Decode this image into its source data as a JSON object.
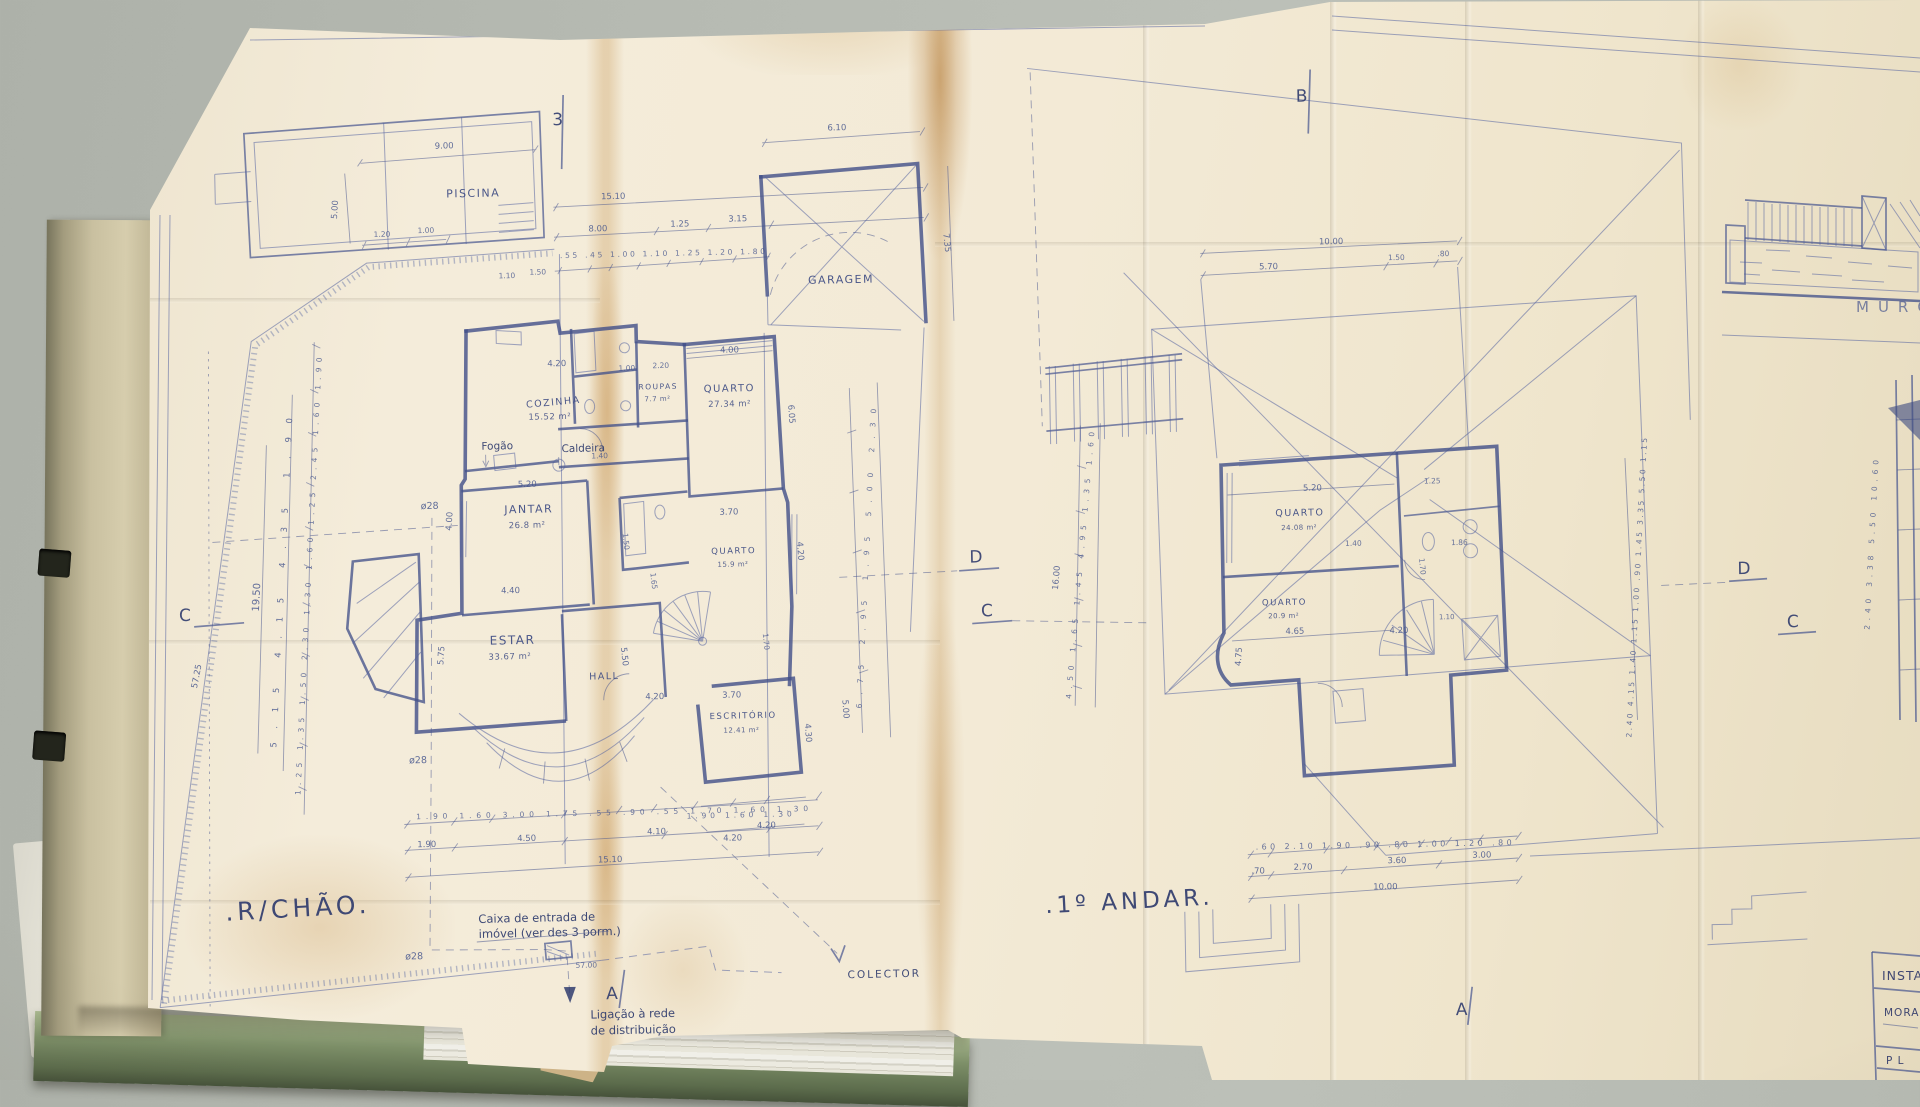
{
  "colors": {
    "desk": "#b7bbb3",
    "paper": "#f3ead6",
    "ink": "#44528b",
    "stain": "#c49249",
    "folder_green": "#7d8f68",
    "cover_tan": "#c9c0a0"
  },
  "ground_floor": {
    "title": ".R/CHÃO.",
    "rooms": {
      "piscina": "PISCINA",
      "garagem": "GARAGEM",
      "cozinha": "COZINHA",
      "cozinha_area": "15.52 m²",
      "roupas": "ROUPAS",
      "roupas_area": "7.7 m²",
      "quarto1": "QUARTO",
      "quarto1_area": "27.34 m²",
      "jantar": "JANTAR",
      "jantar_area": "26.8 m²",
      "estar": "ESTAR",
      "estar_area": "33.67 m²",
      "hall": "HALL",
      "quarto2": "QUARTO",
      "quarto2_area": "15.9 m²",
      "escritorio": "ESCRITÓRIO",
      "escritorio_area": "12.41 m²"
    },
    "equipment": {
      "fogao": "Fogão",
      "caldeira": "Caldeira"
    },
    "notes": {
      "caixa_line1": "Caixa de entrada de",
      "caixa_line2": "imóvel (ver des 3 porm.)",
      "ligacao_line1": "Ligação à rede",
      "ligacao_line2": "de distribuição",
      "colector": "COLECTOR",
      "pipe": "ø28",
      "pipe_drop": "57.00"
    },
    "sections": {
      "top": "3",
      "left": "C",
      "mid_d": "D",
      "mid_c": "C",
      "bottom": "A"
    },
    "dims": {
      "pool_length": "9.00",
      "pool_width": "5.00",
      "pool_a": "1.20",
      "pool_b": "1.00",
      "garage_width": "6.10",
      "garage_depth": "7.35",
      "top_total": "15.10",
      "top_a": "8.00",
      "top_b": "1.25",
      "top_c": "3.15",
      "top_d": "1.10",
      "top_e": "1.50",
      "top_chain": [
        ".55",
        ".45",
        "1.00",
        "1.10",
        "1.25",
        "1.20",
        "1.80"
      ],
      "left_chain": [
        "1.25",
        "1.35",
        "1.50",
        "2.30",
        "1.30",
        "1.60",
        "1.25",
        "2.45",
        "1.60",
        "1.90"
      ],
      "left_groups": [
        "5.15",
        "4.15",
        "4.35",
        "1.90"
      ],
      "left_total": "19.50",
      "right_chain": [
        "6.75",
        "2.95",
        "1.95",
        "5.00",
        "2.30"
      ],
      "bottom_chain": [
        "1.90",
        "1.60",
        "3.00",
        "1.75",
        ".55",
        ".90",
        ".55",
        "1.70",
        "1.60",
        "1.30"
      ],
      "bottom_groups": [
        "1.90",
        "4.50",
        "4.10",
        "4.20"
      ],
      "bottom_total": "15.10",
      "esc_chain": [
        "1.90",
        "1.60",
        "1.30"
      ],
      "boundary": "57.25",
      "inner": [
        "4.20",
        "1.00",
        "2.20",
        "4.00",
        "6.05",
        "5.20",
        "4.40",
        "1.40",
        "1.50",
        "1.65",
        "3.70",
        "4.20",
        "4.00",
        "5.75",
        "5.50",
        "1.70",
        "4.20",
        "3.70",
        "4.30",
        "4.20",
        "5.00"
      ]
    }
  },
  "first_floor": {
    "title": ".1º ANDAR.",
    "rooms": {
      "quarto1": "QUARTO",
      "quarto1_area": "24.08 m²",
      "quarto2": "QUARTO",
      "quarto2_area": "20.9 m²"
    },
    "sections": {
      "top": "B",
      "right_d": "D",
      "right_c": "C",
      "bottom": "A"
    },
    "dims": {
      "top_total": "10.00",
      "top_a": "5.70",
      "top_b": "1.50",
      "top_c": ".80",
      "left_chain": [
        "4.50",
        "1.65",
        "1.45",
        "4.95",
        "1.35",
        "1.60"
      ],
      "left_total": "16.00",
      "right_chain": [
        "2.40",
        "4.15",
        "1.40",
        "1.15",
        "1.00",
        ".90",
        "1.45",
        "3.35",
        "5.50",
        "1.15"
      ],
      "bottom_chain": [
        ".60",
        "2.10",
        "1.90",
        ".90",
        ".80",
        "1.00",
        "1.20",
        ".80"
      ],
      "bottom_groups": [
        ".70",
        "2.70",
        "3.60",
        "3.00"
      ],
      "bottom_total": "10.00",
      "inner": [
        "5.20",
        "1.25",
        "1.40",
        "1.86",
        "4.65",
        "4.20",
        "4.75",
        "1.70",
        "1.10"
      ]
    }
  },
  "margin": {
    "muro": "MURO",
    "edge_chain": [
      "2.40",
      "3.38",
      "5.50",
      "10.60"
    ],
    "titleblock": {
      "row1": "INSTAL",
      "row2": "MORAD",
      "row3": "P L"
    }
  }
}
